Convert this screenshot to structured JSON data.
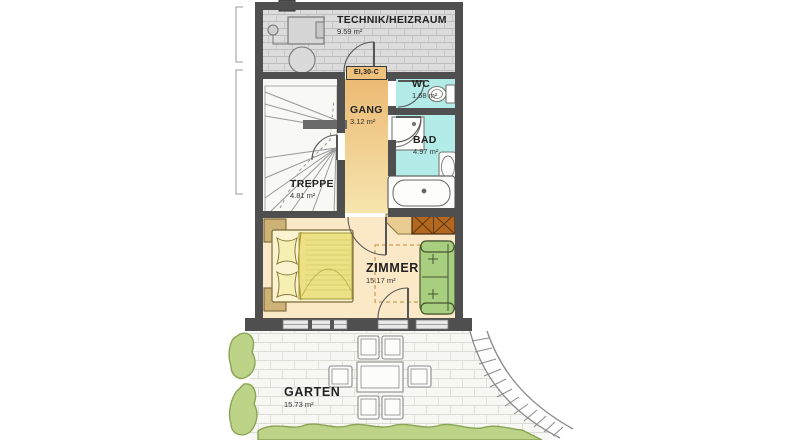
{
  "plan": {
    "type": "floorplan",
    "rooms": {
      "technik": {
        "label": "TECHNIK/HEIZRAUM",
        "area": "9.59 m²"
      },
      "wc": {
        "label": "WC",
        "area": "1.68 m²"
      },
      "gang": {
        "label": "GANG",
        "area": "3.12 m²"
      },
      "bad": {
        "label": "BAD",
        "area": "4.97 m²"
      },
      "treppe": {
        "label": "TREPPE",
        "area": "4.81 m²"
      },
      "zimmer": {
        "label": "ZIMMER",
        "area": "15.17 m²"
      },
      "garten": {
        "label": "GARTEN",
        "area": "15.73 m²"
      }
    },
    "annotations": {
      "fire_door": "EI,30-C"
    },
    "colors": {
      "wall": "#4f4f4f",
      "wet_room": "#b2ebe8",
      "corridor_top": "#ecba74",
      "corridor_bottom": "#f6e5ae",
      "bedroom_floor": "#fbe8c6",
      "bed_blanket": "#ece285",
      "sofa_green": "#a8cf80",
      "wardrobe_orange": "#b4671e",
      "hedge_green": "#bdd488",
      "technik_floor": "#dcdcdc",
      "paving": "#f7f7f3"
    }
  }
}
